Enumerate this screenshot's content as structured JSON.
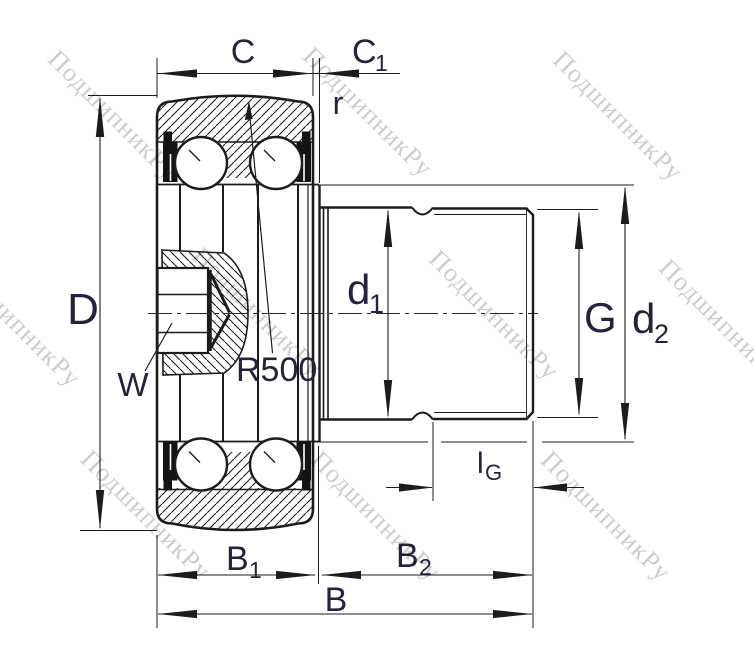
{
  "page": {
    "title": "Stud-type track roller bearing — dimensional cross-section drawing"
  },
  "colors": {
    "line": "#1c1c1c",
    "label": "#23233e",
    "watermark": "#c0c0c8",
    "seal_fill": "#141414",
    "background": "#ffffff"
  },
  "labels": {
    "D": "D",
    "C": "C",
    "C1": {
      "main": "C",
      "sub": "1"
    },
    "r": "r",
    "R500": "R500",
    "W": "W",
    "d1": {
      "main": "d",
      "sub": "1"
    },
    "G": "G",
    "d2": {
      "main": "d",
      "sub": "2"
    },
    "lG": {
      "main": "l",
      "sub": "G"
    },
    "B1": {
      "main": "B",
      "sub": "1"
    },
    "B2": {
      "main": "B",
      "sub": "2"
    },
    "B": "B"
  },
  "watermark": {
    "text": "ПодшипникРу"
  }
}
